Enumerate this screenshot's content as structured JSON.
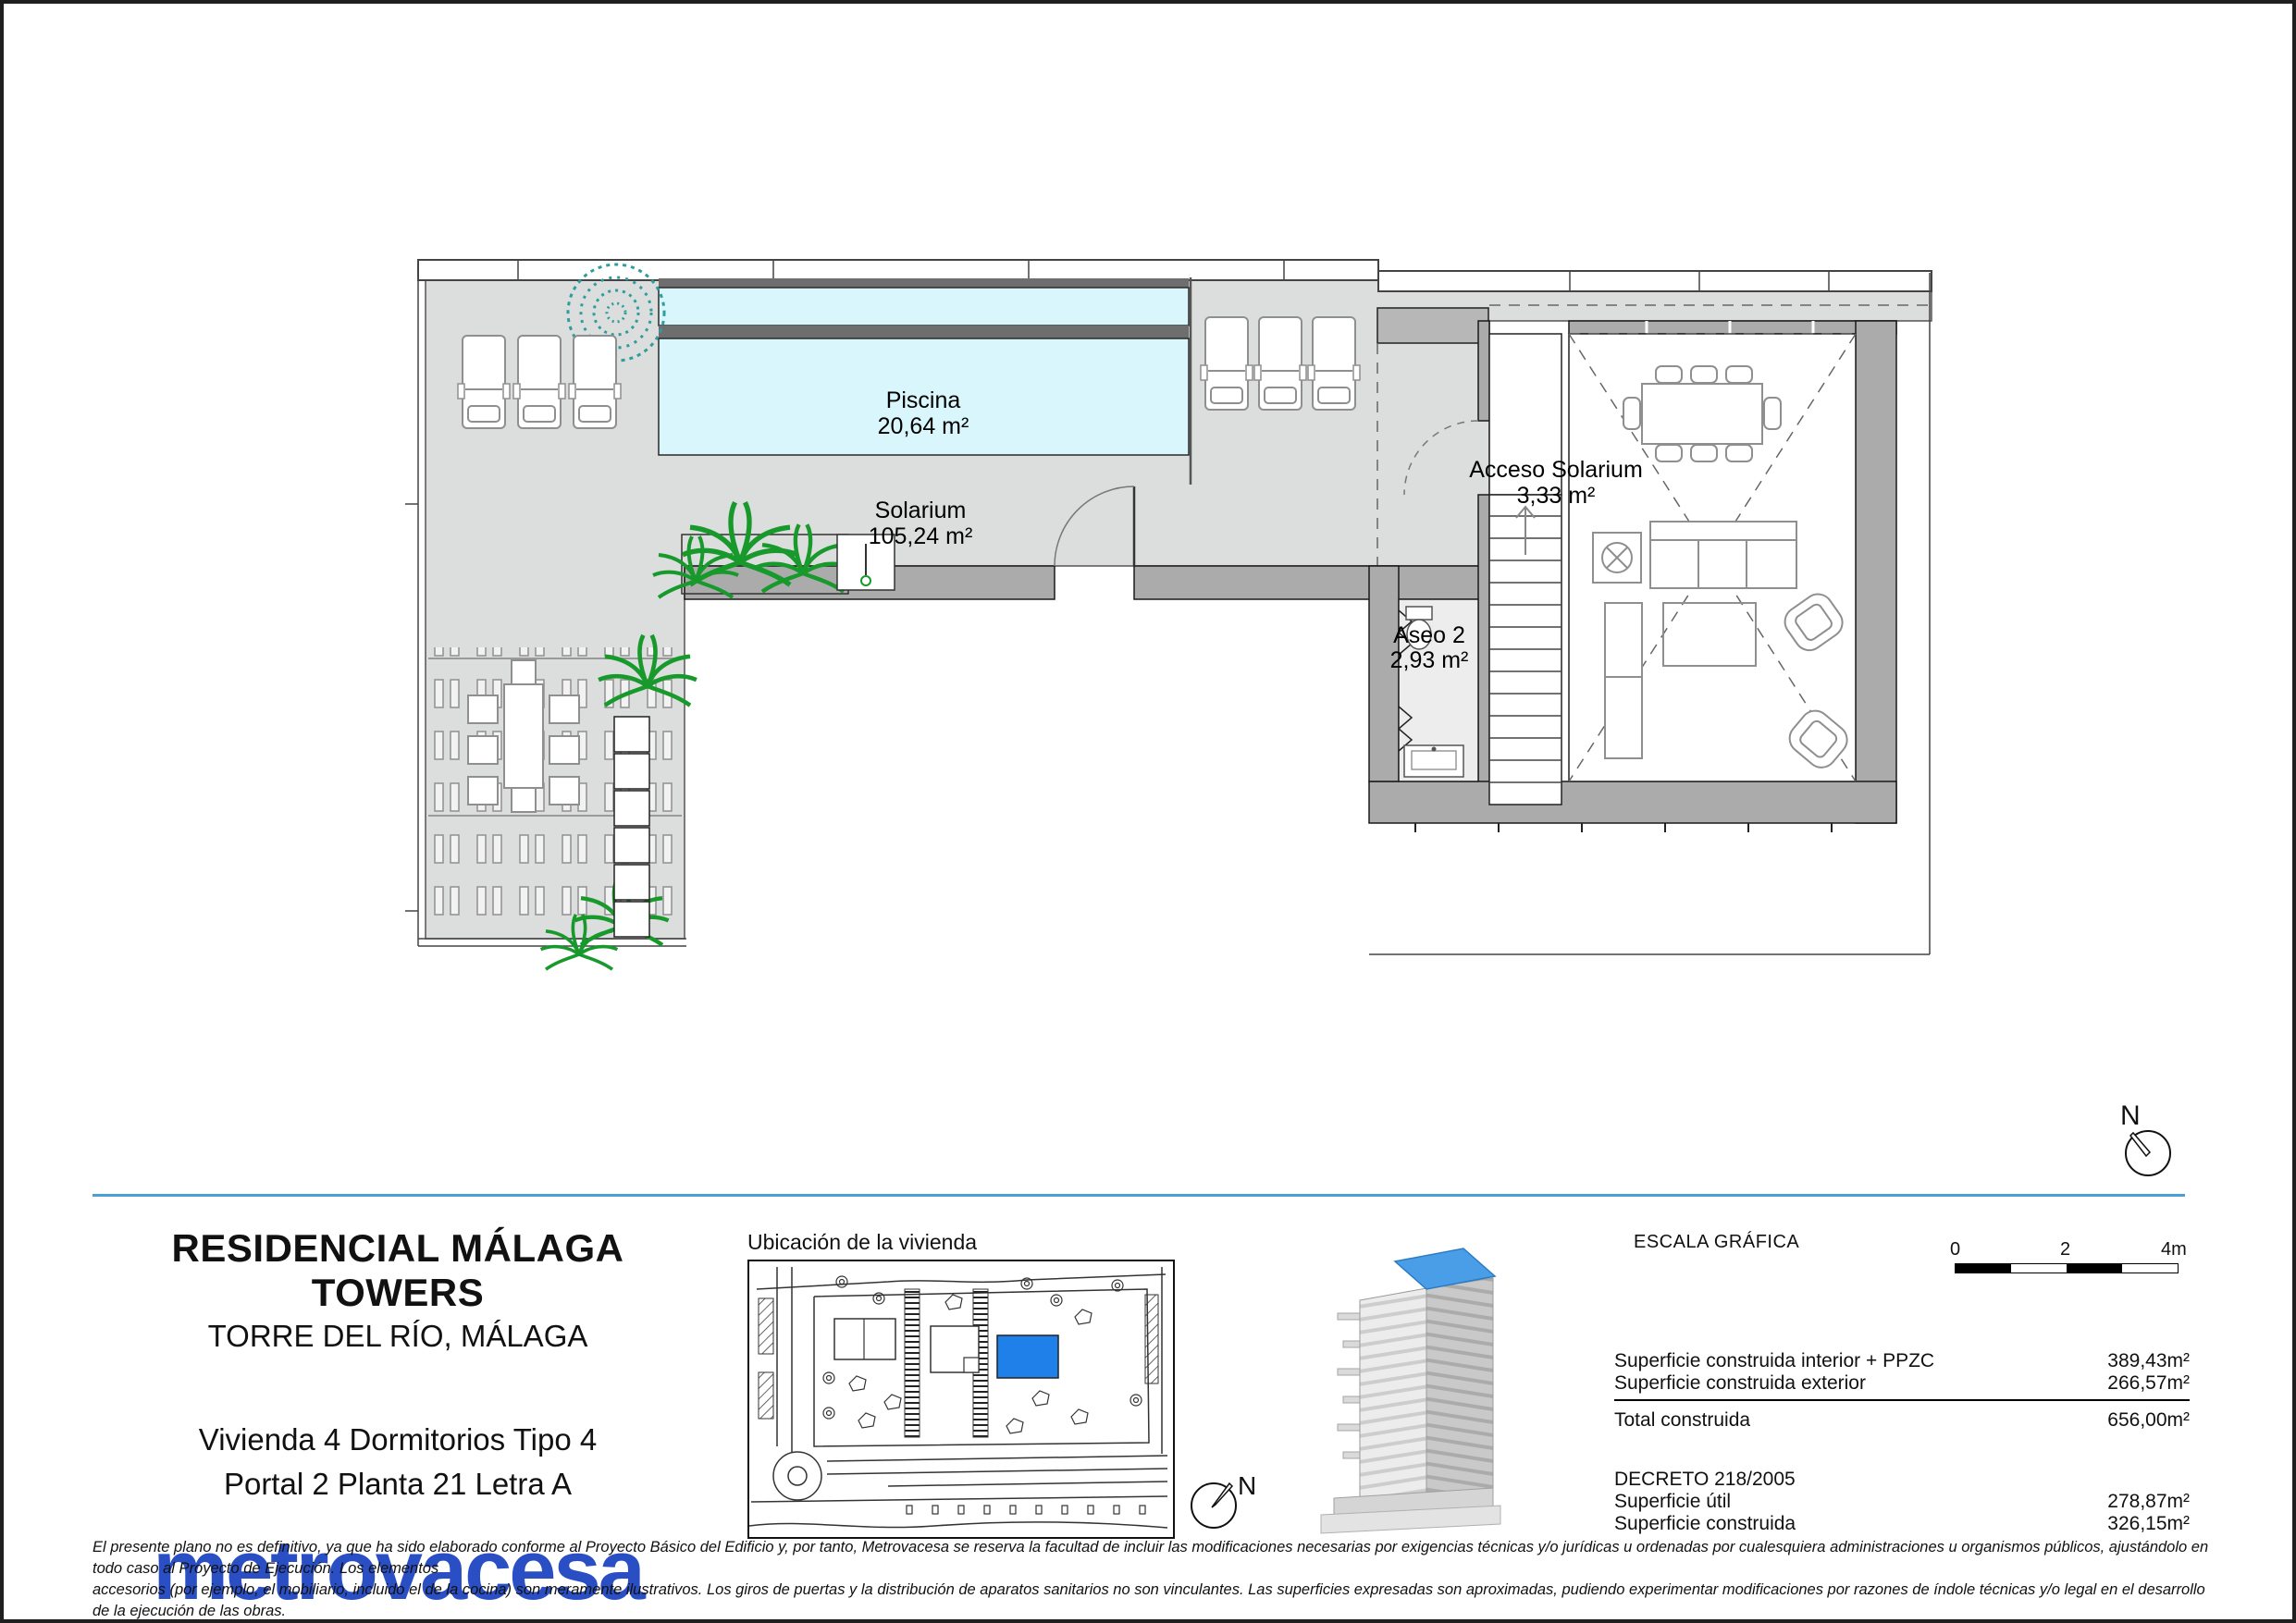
{
  "plan": {
    "north_label": "N",
    "rooms": {
      "piscina": {
        "name": "Piscina",
        "area": "20,64 m²"
      },
      "solarium": {
        "name": "Solarium",
        "area": "105,24 m²"
      },
      "acceso_solarium": {
        "name": "Acceso Solarium",
        "area": "3,33 m²"
      },
      "aseo2": {
        "name": "Aseo 2",
        "area": "2,93 m²"
      }
    }
  },
  "title_block": {
    "project": "RESIDENCIAL MÁLAGA TOWERS",
    "location": "TORRE DEL RÍO, MÁLAGA",
    "unit_type": "Vivienda 4 Dormitorios Tipo 4",
    "unit_address": "Portal 2 Planta 21 Letra A",
    "brand": "metrovacesa"
  },
  "location_map": {
    "title": "Ubicación de la vivienda",
    "north_label": "N"
  },
  "scale_bar": {
    "title": "ESCALA GRÁFICA",
    "tick0": "0",
    "tick2": "2",
    "tick4": "4m"
  },
  "areas_table": {
    "rows": [
      {
        "label": "Superficie construida interior + PPZC",
        "value": "389,43m²"
      },
      {
        "label": "Superficie construida exterior",
        "value": "266,57m²"
      }
    ],
    "total_label": "Total construida",
    "total_value": "656,00m²",
    "decree_title": "DECRETO 218/2005",
    "decree_rows": [
      {
        "label": "Superficie útil",
        "value": "278,87m²"
      },
      {
        "label": "Superficie construida",
        "value": "326,15m²"
      }
    ]
  },
  "disclaimer": {
    "line1": "El presente plano no es definitivo, ya que ha sido elaborado conforme al Proyecto Básico del Edificio y, por tanto, Metrovacesa se reserva la facultad de incluir las modificaciones necesarias por exigencias técnicas y/o jurídicas u ordenadas por cualesquiera administraciones u organismos públicos, ajustándolo en todo caso al Proyecto de Ejecución. Los elementos",
    "line2": "accesorios (por ejemplo, el mobiliario, incluido el de la cocina) son meramente ilustrativos. Los giros de puertas y la distribución de aparatos sanitarios no son vinculantes. Las superficies expresadas son aproximadas, pudiendo experimentar modificaciones por razones de índole técnicas y/o legal en el desarrollo de la ejecución de las obras."
  },
  "colors": {
    "brand_blue": "#2a4fc4",
    "highlight_blue": "#1e80e8",
    "separator_blue": "#4aa0d5",
    "pool_cyan": "#d8f6fb",
    "terrace_gray": "#dcdddd",
    "wall_gray": "#ababab"
  }
}
